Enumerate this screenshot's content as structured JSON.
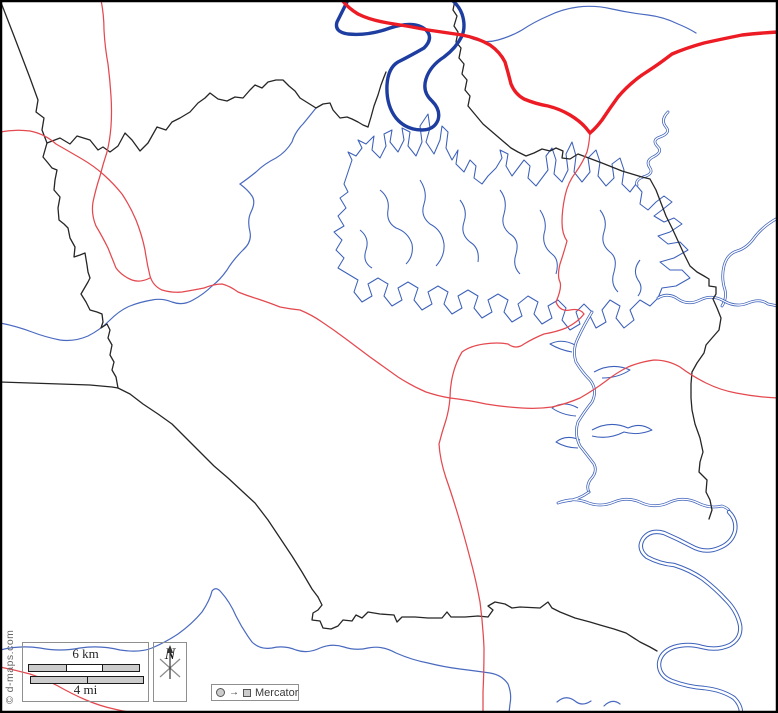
{
  "attribution": "© d-maps.com",
  "scale_bar": {
    "km_label": "6 km",
    "mi_label": "4 mi"
  },
  "compass": {
    "north_label": "N"
  },
  "projection": {
    "label": "Mercator"
  },
  "colors": {
    "frame": "#000000",
    "boundary": "#262626",
    "major_river": "#1d3da0",
    "stream": "#4a6ac0",
    "lake": "#3c60ba",
    "road_major": "#ec1b24",
    "road_minor": "#e4494f",
    "box_border": "#8f8f8f",
    "bar_fill": "#cccccc",
    "text": "#222222",
    "muted": "#666666"
  }
}
